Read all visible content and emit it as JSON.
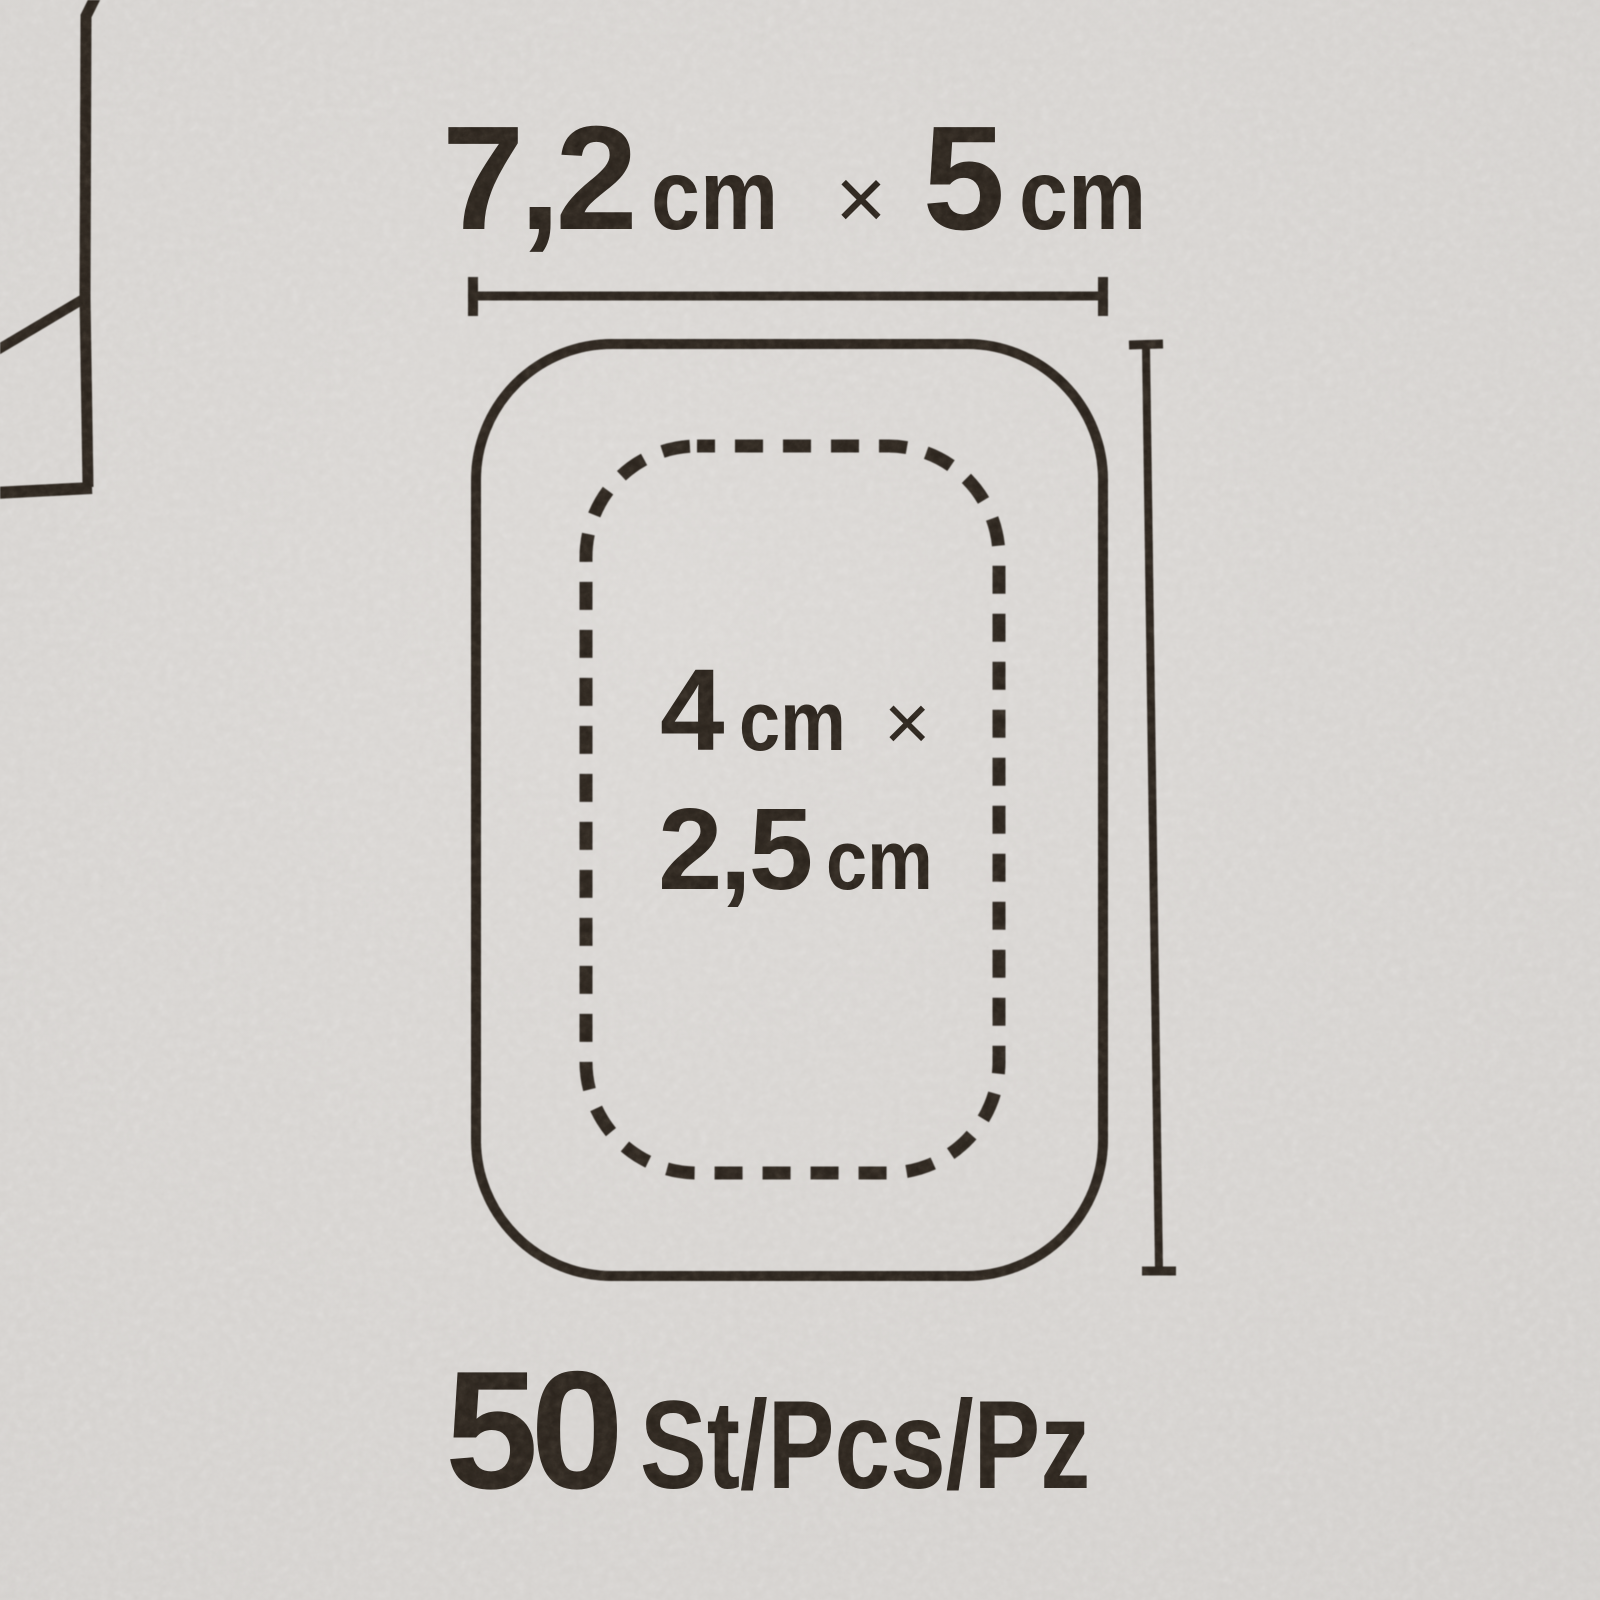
{
  "colors": {
    "paper": "#d5d2cf",
    "ink": "#2a231c"
  },
  "outer_size_label": {
    "width_value": "7,2",
    "width_unit": "cm",
    "multiply": "×",
    "height_value": "5",
    "height_unit": "cm"
  },
  "pad_size_label": {
    "width_value": "4",
    "width_unit": "cm",
    "multiply": "×",
    "height_value": "2,5",
    "height_unit": "cm"
  },
  "quantity_label": {
    "count": "50",
    "units": "St/Pcs/Pz"
  }
}
